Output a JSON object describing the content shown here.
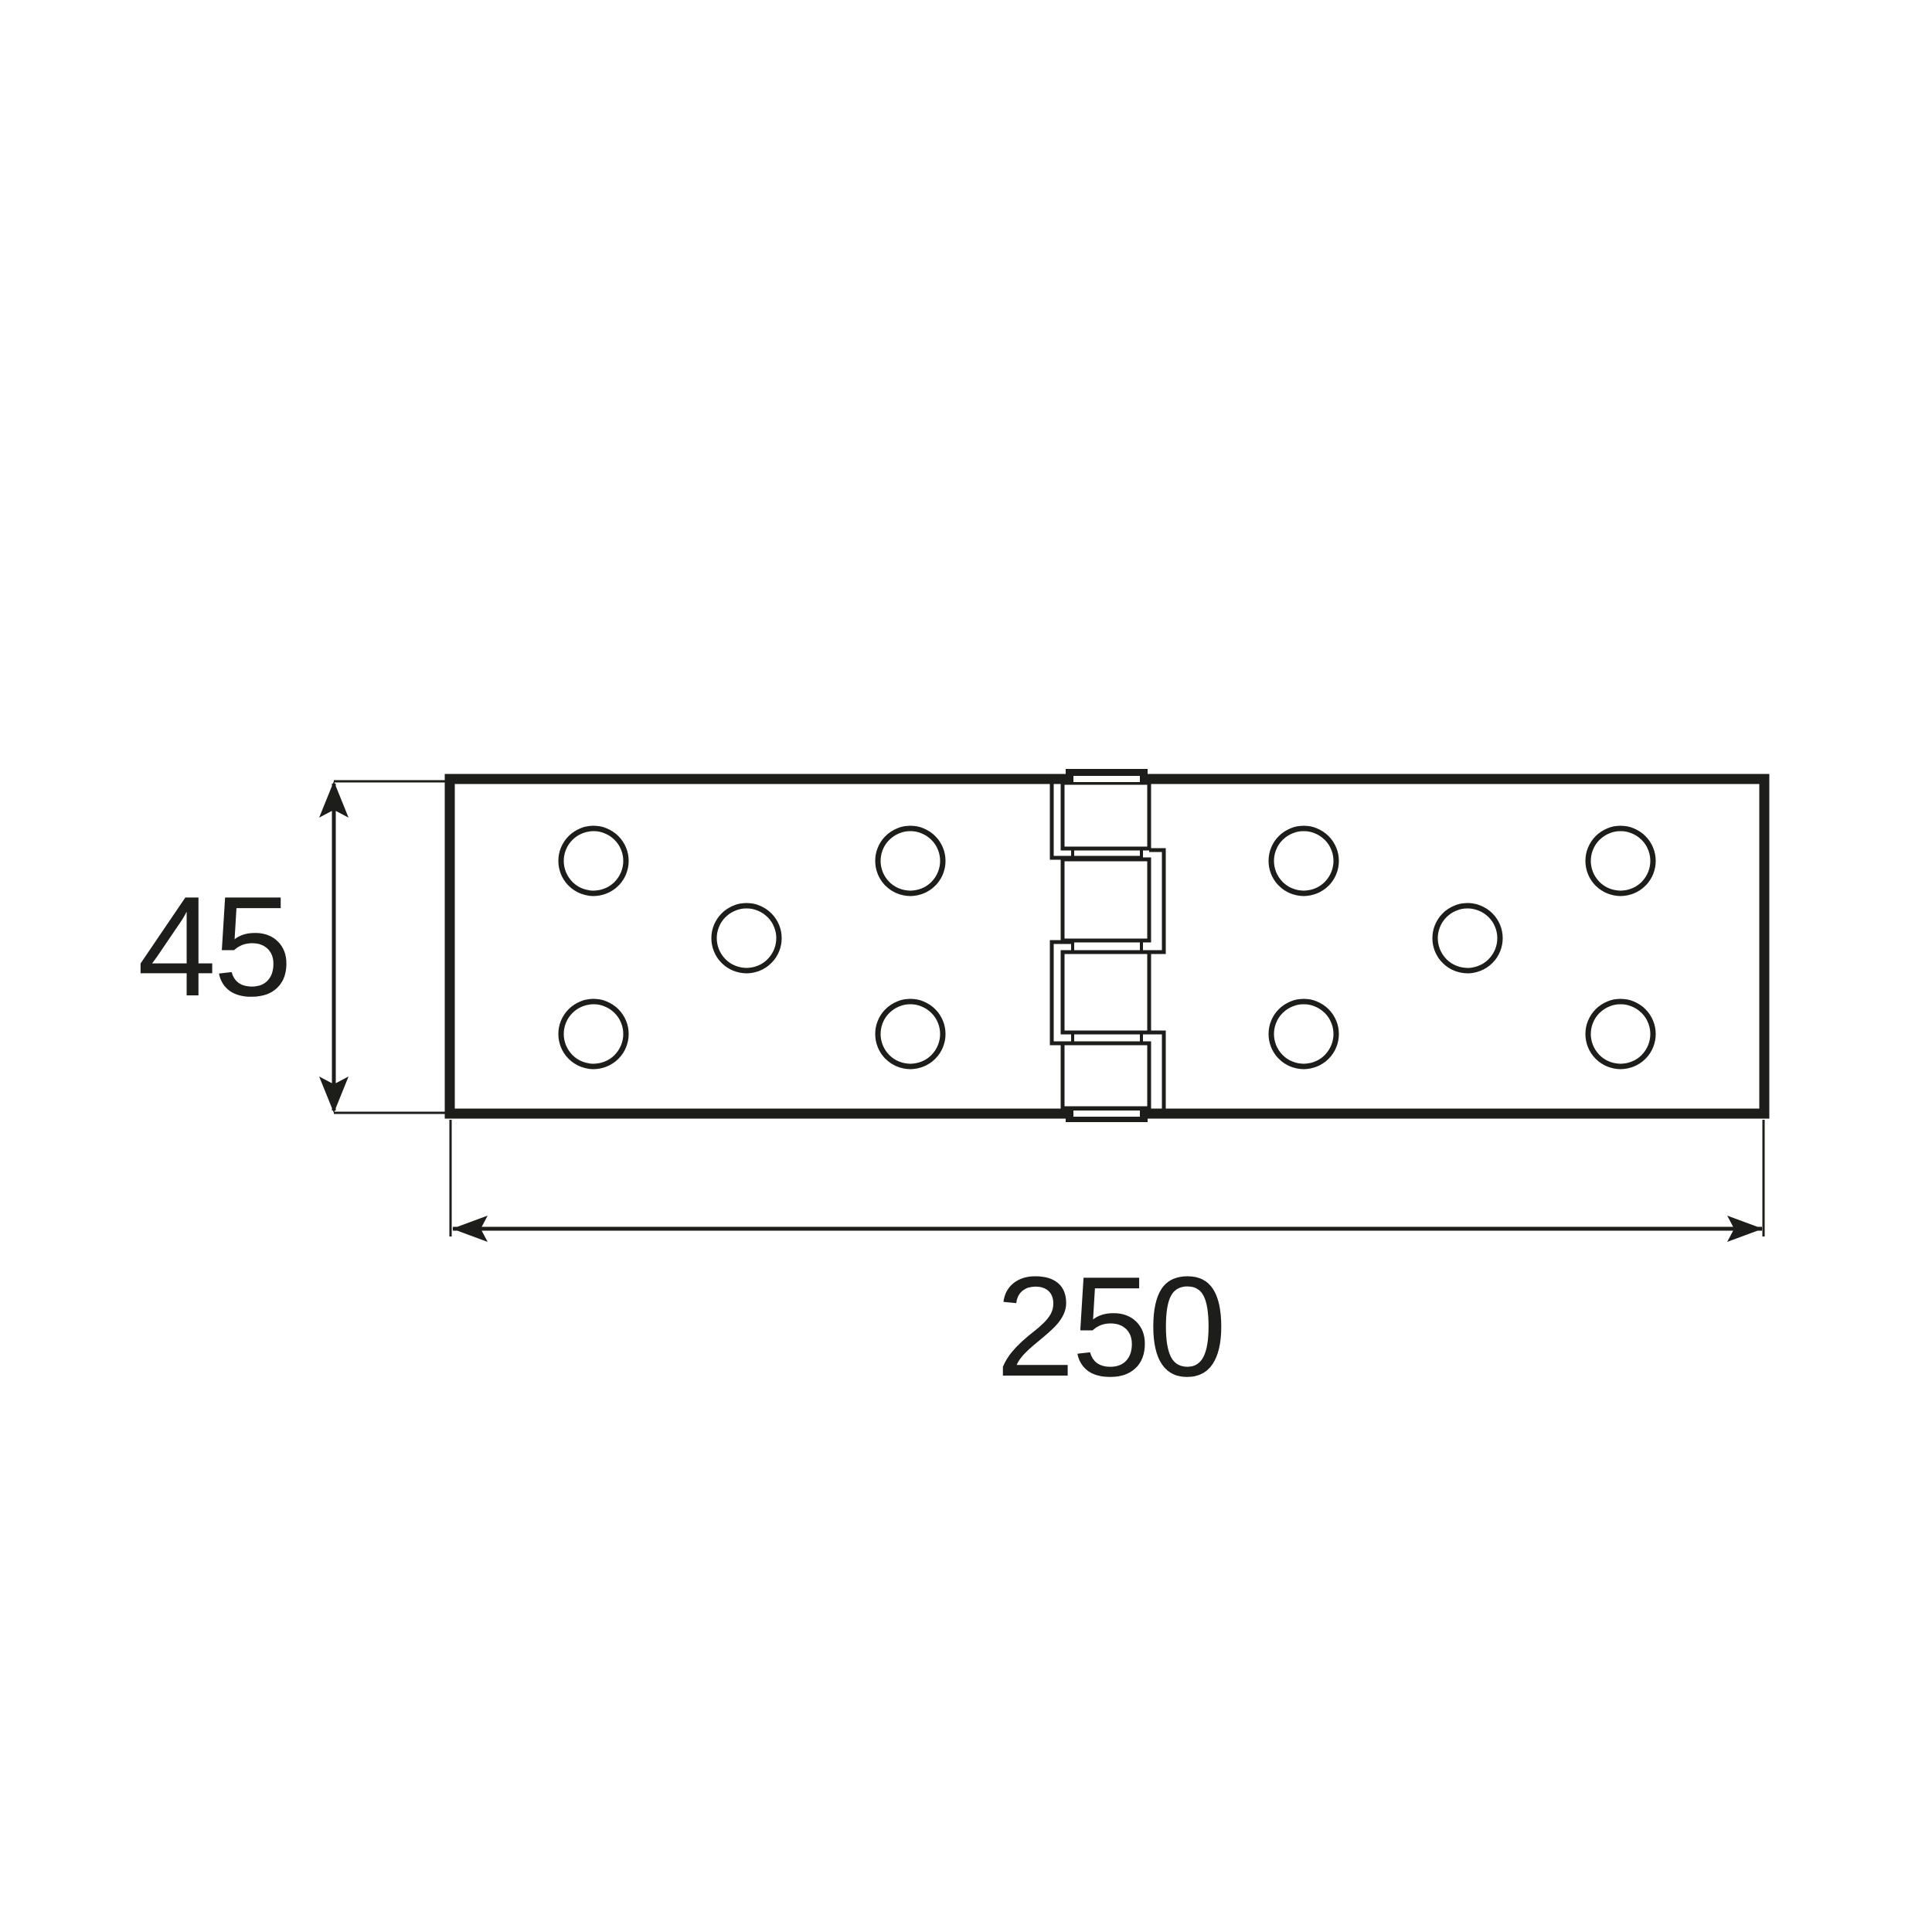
{
  "drawing": {
    "title": "hinge-technical-drawing",
    "width_dimension": {
      "label": "250"
    },
    "height_dimension": {
      "label": "45"
    },
    "screw_hole_count": 10,
    "knuckle_segment_count": 4,
    "colors": {
      "ink": "#1d1d1b",
      "background": "#ffffff"
    }
  }
}
